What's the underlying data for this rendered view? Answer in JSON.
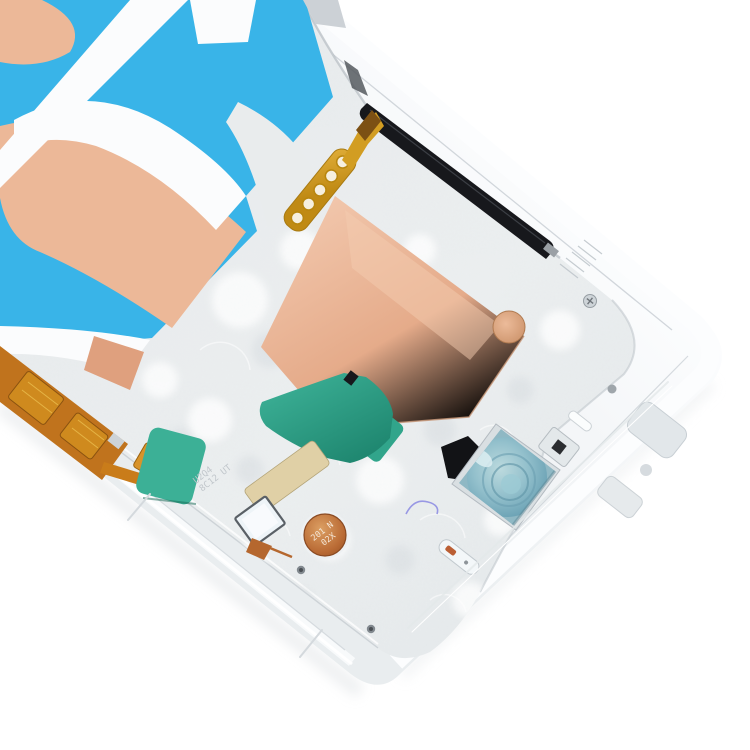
{
  "meta": {
    "type": "product-photo",
    "subject": "Silver smartphone LCD mid-frame bezel plate, shown diagonally on a white background",
    "background_color": "#ffffff"
  },
  "palette": {
    "background": "#ffffff",
    "frame_silver": "#f3f5f7",
    "rail_white": "#fbfcfd",
    "cavity_silver": "#e9eced",
    "edge_line": "#c6ccd1",
    "film_blue": "#39b4e8",
    "copper": "#ecb898",
    "copper_deep": "#dfa07e",
    "copper_coin": "#b96a34",
    "tape_green": "#2aa287",
    "tape_green_dark": "#1e8a72",
    "flex_orange": "#c0731d",
    "flex_pad_gold": "#cf8a1e",
    "connector_gold": "#d29d22",
    "slot_black": "#17181c",
    "lens_blue": "#8fb8c4",
    "sticker_tan": "#d3c298",
    "sticker_white": "#eef4f8"
  },
  "markings": {
    "coin_line1": "201 N",
    "coin_line2": "02X",
    "etch_line1": "U2Q4",
    "etch_line2": "8C12 UT"
  },
  "parts": {
    "frame": "silver mid-frame plate",
    "antenna_film": "blue antenna film",
    "heat_spreader": "copper heat spreader plates",
    "tapes": "green adhesive tape patches",
    "flex_cable": "orange flex cable",
    "board_connector": "gold 5-pad board connector",
    "camera_pocket": "front camera pocket with blue lens rings",
    "side_slot": "black side-key slot",
    "coin_marking": "laser-etched copper disc",
    "shield_sticker": "tan and white shield stickers"
  }
}
